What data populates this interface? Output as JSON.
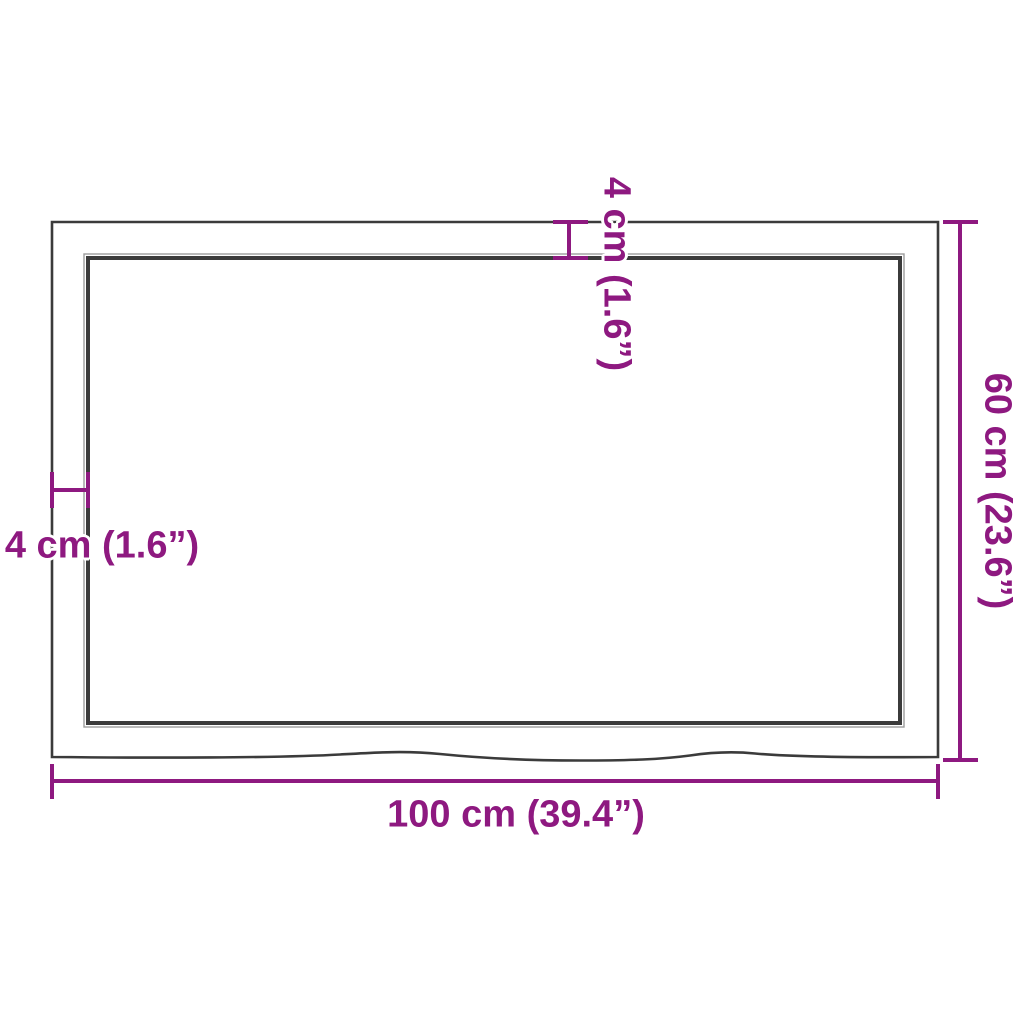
{
  "diagram": {
    "type": "product-dimension-diagram",
    "subject": "rectangular tabletop with live (wavy) front edge, top view",
    "labels": {
      "width": "100 cm (39.4”)",
      "height": "60 cm (23.6”)",
      "thickness_top": "4 cm (1.6”)",
      "thickness_left": "4 cm (1.6”)"
    },
    "dimensions": {
      "width_cm": 100,
      "width_in": 39.4,
      "height_cm": 60,
      "height_in": 23.6,
      "edge_thickness_cm": 4,
      "edge_thickness_in": 1.6
    },
    "colors": {
      "dimension_magenta": "#8E1980",
      "outline_dark": "#3B3B3B",
      "outline_light": "#9C9C9C",
      "background": "#FFFFFF"
    }
  }
}
